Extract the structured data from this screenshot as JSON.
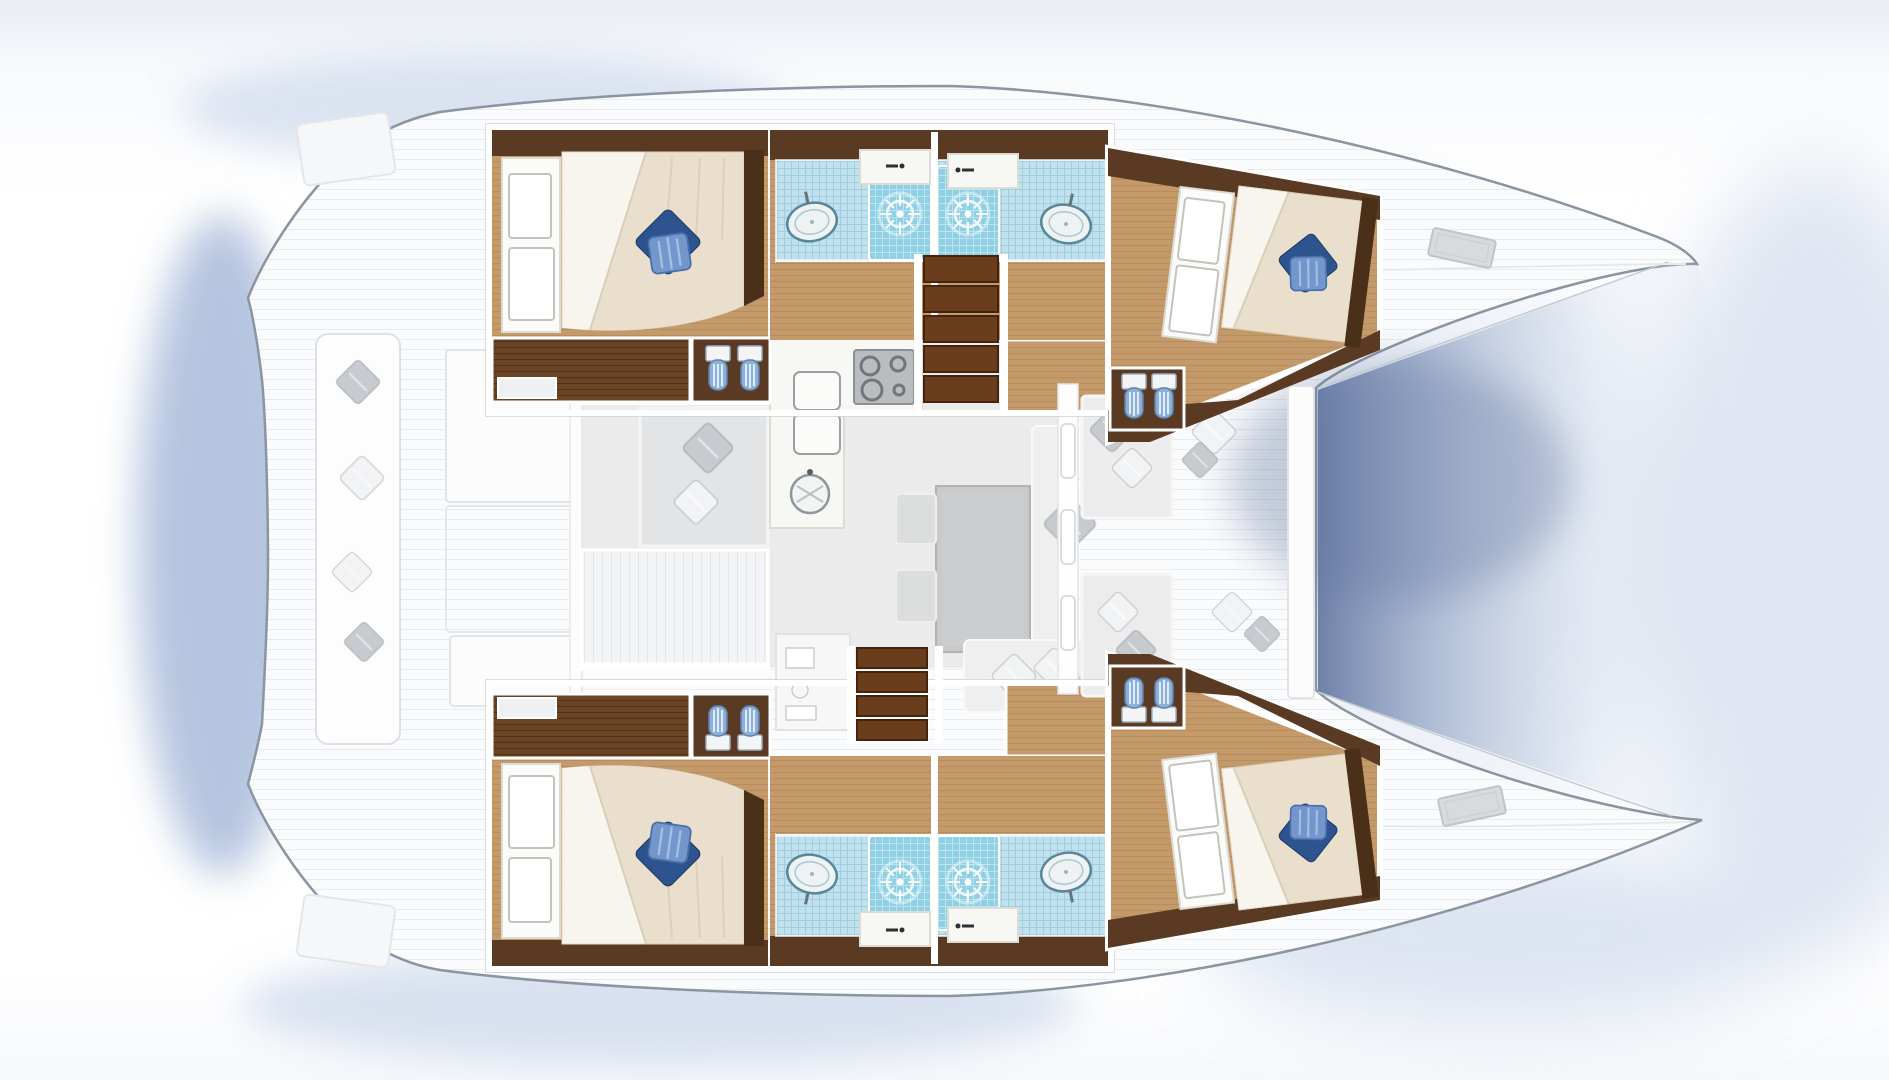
{
  "meta": {
    "title": "Catamaran yacht interior floor plan (top view)",
    "description": "Bird's-eye layout drawing: four double cabins with blue pillows, four shower rooms with wash basins and shower roses, twin toilet fixtures per head, central saloon with galley, fridge, stove, round sink and dining table, aft cockpit benches, forward cockpit loungers, twin bows with foredeck hatches and water shadow between the hulls."
  },
  "inventory": {
    "cabins": 4,
    "double_beds": 4,
    "blue_bed_pillows": 4,
    "bathrooms": 4,
    "wash_basins": 4,
    "shower_roses": 4,
    "toilet_fixtures": 8,
    "stair_flights": 2,
    "dining_table": 1,
    "galley_burners": 4,
    "galley_sink": 1,
    "fridge_units": 2,
    "foredeck_hatches": 2,
    "cockpit_benches": 4
  },
  "colors": {
    "background": "#ffffff",
    "backdropTint": "#e9edf4",
    "shadowBlue": "#8ea6cf",
    "shadowSoft": "#c6d3e8",
    "hullFill": "#fafbfc",
    "hullLine": "#8a95a1",
    "deckSeam": "#e9ebee",
    "waterDark": "#5f739e",
    "waterMid": "#8ea2c4",
    "waterLight": "#cfd9ea",
    "wood": "#c59a6b",
    "woodGrain": "#a97f4f",
    "woodDark": "#6b4426",
    "woodWall": "#5a3a22",
    "stairTread": "#6a3d1d",
    "stairGap": "#43250f",
    "bedBase": "#e9dfcc",
    "bedSheet": "#f8f5ee",
    "bedHead": "#4a3018",
    "pillowNavy": "#2e548f",
    "pillowBlue": "#7397cd",
    "pillowBlueLine": "#4a6ea8",
    "tile": "#bfe2ee",
    "tileLine": "#7fb4cc",
    "tileShower": "#8fd0e4",
    "fixture": "#eef2f3",
    "fixtureLine": "#58869a",
    "toiletTank": "#f2f4f6",
    "toiletBowl": "#8cb0dc",
    "toiletLine": "#5d82ad",
    "saloonFloor": "#ebebeb",
    "tableTop": "#c7c9ca",
    "tableLine": "#b0b2b4",
    "seatGray": "#dcdddd",
    "sofa": "#efefef",
    "pillowGray": "#c7cbd0",
    "pillowWhite": "#f2f3f5",
    "counter": "#f7f7f4",
    "counterLine": "#dcdcd6",
    "stove": "#b9bdc0",
    "stoveBurner": "#70767b",
    "wallWhite": "#ffffff",
    "wallCase": "#cdd2d7",
    "hatchGray": "#d8dbde"
  }
}
